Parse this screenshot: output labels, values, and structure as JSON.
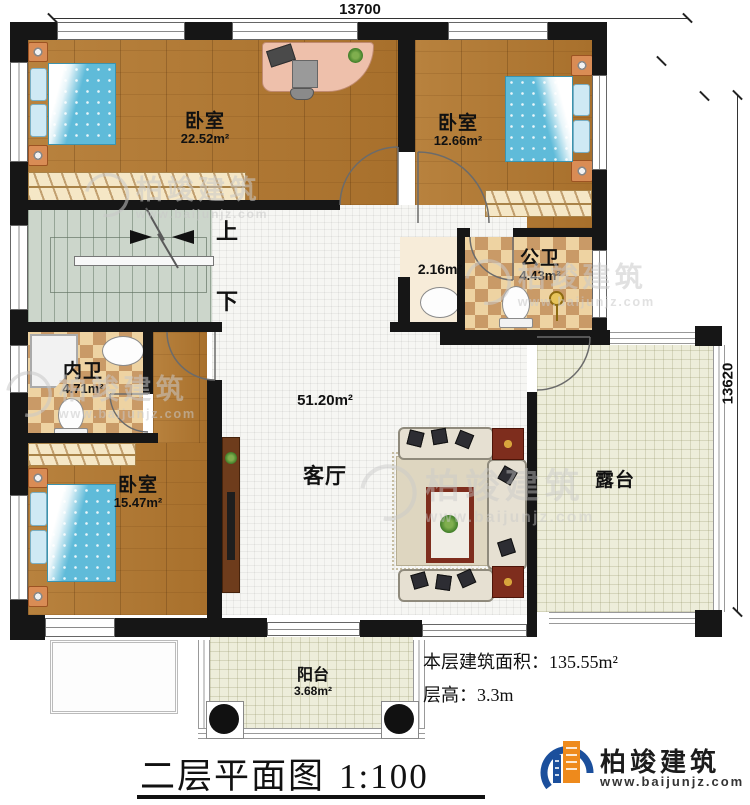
{
  "dimensions": {
    "top": "13700",
    "right": "13620"
  },
  "rooms": {
    "bedroom1": {
      "label": "卧室",
      "area": "22.52m²"
    },
    "bedroom2": {
      "label": "卧室",
      "area": "12.66m²"
    },
    "bedroom3": {
      "label": "卧室",
      "area": "15.47m²"
    },
    "living": {
      "label": "客厅",
      "area": "51.20m²"
    },
    "public_bath": {
      "label": "公卫",
      "area": "4.43m²"
    },
    "inner_bath": {
      "label": "内卫",
      "area": "4.71m²"
    },
    "wash_niche": {
      "area": "2.16m²"
    },
    "terrace": {
      "label": "露台"
    },
    "balcony": {
      "label": "阳台",
      "area": "3.68m²"
    }
  },
  "stairs": {
    "up_label": "上",
    "down_label": "下"
  },
  "summary": {
    "area_label": "本层建筑面积：",
    "area_value": "135.55m²",
    "height_label": "层高：",
    "height_value": "3.3m"
  },
  "title": {
    "main": "二层平面图",
    "scale": "1:100"
  },
  "brand": {
    "name": "柏竣建筑",
    "website": "www.baijunjz.com"
  },
  "watermark": {
    "name": "柏竣建筑",
    "website": "www.baijunjz.com"
  },
  "colors": {
    "wall": "#161616",
    "wood_floor": "#b07a36",
    "tile_floor": "#f6f6f3",
    "checker_light": "#eed3a2",
    "checker_dark": "#c99a67",
    "stair_floor": "#ccd6cb",
    "outdoor_floor": "#ededda",
    "bed_blue": "#5fbbd9",
    "brand_blue": "#1b4f9c",
    "brand_orange": "#ee8a1c",
    "accent_red": "#7e2d1d"
  }
}
